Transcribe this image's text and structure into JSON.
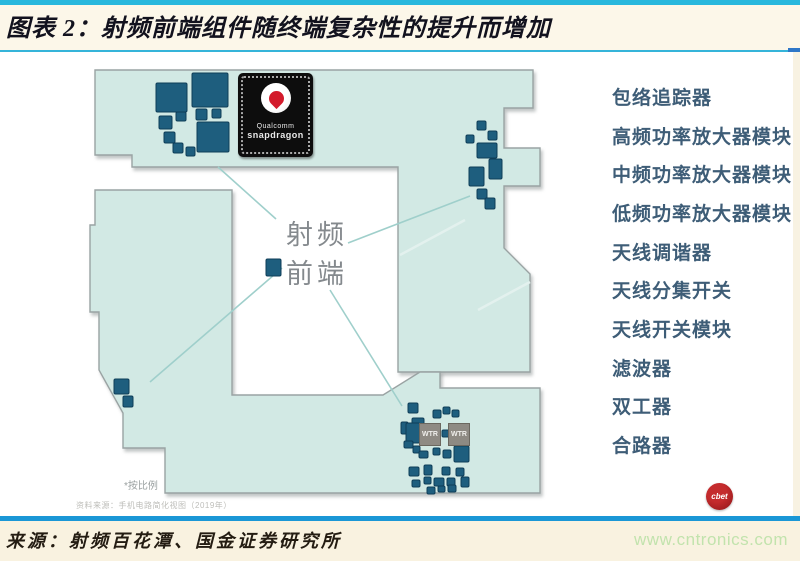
{
  "title": "图表 2：射频前端组件随终端复杂性的提升而增加",
  "legend": {
    "items": [
      "包络追踪器",
      "高频功率放大器模块",
      "中频功率放大器模块",
      "低频功率放大器模块",
      "天线调谐器",
      "天线分集开关",
      "天线开关模块",
      "滤波器",
      "双工器",
      "合路器"
    ]
  },
  "diagram": {
    "center_label": [
      "射频",
      "前端"
    ],
    "chip": {
      "brand_line1": "Qualcomm",
      "brand_line2": "snapdragon"
    },
    "wtr_label": "WTR",
    "scale_note": "*按比例",
    "fine_print": "资料来源：手机电路简化视图（2019年）",
    "logo_text": "cbet",
    "colors": {
      "board_fill": "#d2e9e4",
      "board_stroke": "#9aa3a3",
      "component": "#1e5e7e",
      "component_border": "#0f3e58",
      "leader_line": "#9fcfcb",
      "title_rule_cyan": "#35b4d9",
      "top_bar_cyan": "#29b8dd",
      "footer_bar_blue": "#1a97d6",
      "footer_bg_cream": "#f9f2e0",
      "url_green": "#c2e3ad",
      "legend_text": "#3e5d77"
    },
    "board_polygons": [
      "95,70 533,70 533,108 504,108 504,148 540,148 540,186 504,186 504,248 530,274 530,372 398,372 398,167 132,167 132,155 95,155",
      "95,190 232,190 232,395 383,395 420,372 440,372 440,388 540,388 540,493 165,493 165,448 123,448 123,413 99,370 99,312 90,312 90,225 95,225"
    ],
    "leader_lines": [
      [
        218,
        167,
        276,
        219
      ],
      [
        348,
        243,
        470,
        196
      ],
      [
        282,
        268,
        150,
        382
      ],
      [
        330,
        290,
        402,
        406
      ]
    ],
    "glare_lines": [
      [
        400,
        255,
        465,
        220
      ],
      [
        478,
        310,
        530,
        282
      ]
    ],
    "components": [
      [
        156,
        83,
        31,
        29
      ],
      [
        192,
        73,
        36,
        34
      ],
      [
        159,
        116,
        13,
        13
      ],
      [
        176,
        112,
        10,
        9
      ],
      [
        196,
        109,
        11,
        11
      ],
      [
        212,
        109,
        9,
        9
      ],
      [
        197,
        122,
        32,
        30
      ],
      [
        164,
        132,
        11,
        11
      ],
      [
        173,
        143,
        10,
        10
      ],
      [
        186,
        147,
        9,
        9
      ],
      [
        477,
        121,
        9,
        9
      ],
      [
        488,
        131,
        9,
        9
      ],
      [
        466,
        135,
        8,
        8
      ],
      [
        477,
        143,
        20,
        15
      ],
      [
        489,
        159,
        13,
        20
      ],
      [
        469,
        167,
        15,
        19
      ],
      [
        477,
        189,
        10,
        10
      ],
      [
        485,
        198,
        10,
        11
      ],
      [
        114,
        379,
        15,
        15
      ],
      [
        123,
        396,
        10,
        11
      ],
      [
        266,
        259,
        15,
        17
      ],
      [
        408,
        403,
        10,
        10
      ],
      [
        412,
        418,
        12,
        10
      ],
      [
        433,
        410,
        8,
        8
      ],
      [
        443,
        407,
        7,
        7
      ],
      [
        452,
        410,
        7,
        7
      ],
      [
        401,
        422,
        7,
        12
      ],
      [
        406,
        423,
        14,
        20
      ],
      [
        442,
        430,
        7,
        7
      ],
      [
        404,
        441,
        9,
        7
      ],
      [
        413,
        446,
        7,
        7
      ],
      [
        419,
        451,
        9,
        7
      ],
      [
        433,
        448,
        7,
        7
      ],
      [
        443,
        450,
        8,
        8
      ],
      [
        454,
        446,
        15,
        16
      ],
      [
        409,
        467,
        10,
        9
      ],
      [
        424,
        465,
        8,
        10
      ],
      [
        442,
        467,
        8,
        8
      ],
      [
        456,
        468,
        8,
        8
      ],
      [
        412,
        480,
        8,
        7
      ],
      [
        424,
        477,
        7,
        7
      ],
      [
        434,
        478,
        10,
        8
      ],
      [
        447,
        478,
        8,
        8
      ],
      [
        461,
        477,
        8,
        10
      ],
      [
        427,
        487,
        8,
        7
      ],
      [
        438,
        486,
        7,
        6
      ],
      [
        448,
        485,
        8,
        7
      ]
    ],
    "wtr_positions": [
      [
        419,
        423
      ],
      [
        448,
        423
      ]
    ]
  },
  "footer": {
    "source": "来源：射频百花潭、国金证券研究所",
    "url": "www.cntronics.com"
  }
}
